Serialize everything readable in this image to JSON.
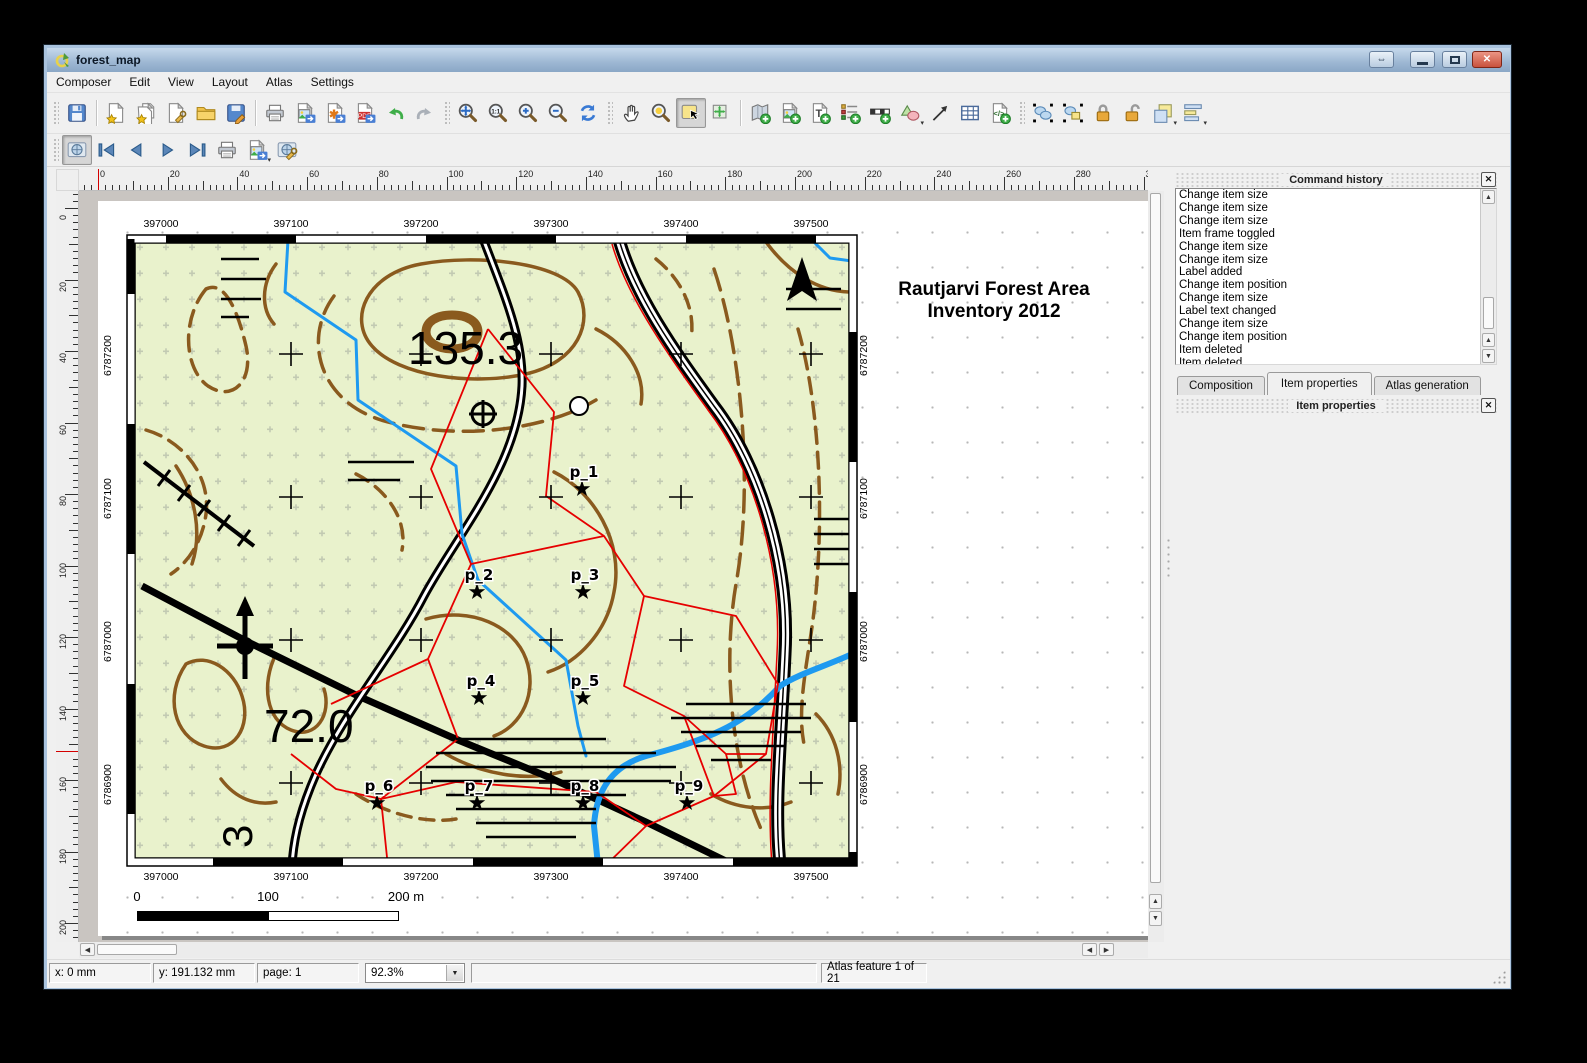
{
  "window": {
    "title": "forest_map"
  },
  "titlebar": {
    "buttons": [
      {
        "name": "resize",
        "glyph": "arrows"
      },
      {
        "name": "minimize",
        "glyph": "minimize"
      },
      {
        "name": "maximize",
        "glyph": "maximize"
      },
      {
        "name": "close",
        "glyph": "close"
      }
    ]
  },
  "menu": {
    "items": [
      "Composer",
      "Edit",
      "View",
      "Layout",
      "Atlas",
      "Settings"
    ]
  },
  "toolbars": {
    "main": {
      "groups": [
        {
          "lead": "grip",
          "items": [
            {
              "name": "save-project",
              "icon": "save"
            }
          ]
        },
        {
          "lead": "sep",
          "items": [
            {
              "name": "new-composition",
              "icon": "page-star"
            },
            {
              "name": "duplicate-composition",
              "icon": "pages-star"
            },
            {
              "name": "composition-manager",
              "icon": "page-wrench"
            },
            {
              "name": "load-from-template",
              "icon": "folder"
            },
            {
              "name": "save-as-template",
              "icon": "save-edit"
            }
          ]
        },
        {
          "lead": "sep",
          "items": [
            {
              "name": "print",
              "icon": "print"
            },
            {
              "name": "export-as-image",
              "icon": "export-image"
            },
            {
              "name": "export-as-svg",
              "icon": "export-svg"
            },
            {
              "name": "export-as-pdf",
              "icon": "export-pdf"
            },
            {
              "name": "undo",
              "icon": "undo"
            },
            {
              "name": "redo",
              "icon": "redo"
            }
          ]
        },
        {
          "lead": "grip",
          "items": [
            {
              "name": "zoom-full",
              "icon": "zoom-full"
            },
            {
              "name": "zoom-actual-size",
              "icon": "zoom-11"
            },
            {
              "name": "zoom-in",
              "icon": "zoom-in"
            },
            {
              "name": "zoom-out",
              "icon": "zoom-out"
            },
            {
              "name": "refresh-view",
              "icon": "refresh"
            }
          ]
        },
        {
          "lead": "grip",
          "items": [
            {
              "name": "pan",
              "icon": "pan"
            },
            {
              "name": "zoom-region",
              "icon": "zoom-tool"
            },
            {
              "name": "select-move-item",
              "icon": "select",
              "pressed": true
            },
            {
              "name": "move-item-content",
              "icon": "move-content"
            }
          ]
        },
        {
          "lead": "sep",
          "items": [
            {
              "name": "add-new-map",
              "icon": "add-map"
            },
            {
              "name": "add-image",
              "icon": "add-image"
            },
            {
              "name": "add-new-label",
              "icon": "add-label"
            },
            {
              "name": "add-new-legend",
              "icon": "add-legend"
            },
            {
              "name": "add-new-scalebar",
              "icon": "add-scalebar"
            },
            {
              "name": "add-basic-shape",
              "icon": "add-shape",
              "dd": true
            },
            {
              "name": "add-arrow",
              "icon": "add-arrow"
            },
            {
              "name": "add-attribute-table",
              "icon": "add-table"
            },
            {
              "name": "add-html-frame",
              "icon": "add-html"
            }
          ]
        },
        {
          "lead": "grip",
          "items": [
            {
              "name": "group-items",
              "icon": "group"
            },
            {
              "name": "ungroup-items",
              "icon": "ungroup"
            },
            {
              "name": "lock-selected-items",
              "icon": "lock"
            },
            {
              "name": "unlock-all-items",
              "icon": "unlock"
            },
            {
              "name": "raise-selected-items",
              "icon": "raise",
              "dd": true
            },
            {
              "name": "align-selected-items",
              "icon": "align",
              "dd": true
            }
          ]
        }
      ]
    },
    "atlas": {
      "groups": [
        {
          "lead": "grip",
          "items": [
            {
              "name": "preview-atlas",
              "icon": "atlas-preview",
              "pressed": true
            },
            {
              "name": "first-feature",
              "icon": "first"
            },
            {
              "name": "previous-feature",
              "icon": "prev"
            },
            {
              "name": "next-feature",
              "icon": "next"
            },
            {
              "name": "last-feature",
              "icon": "last"
            },
            {
              "name": "print-atlas",
              "icon": "print"
            },
            {
              "name": "export-atlas-as-image",
              "icon": "export-image",
              "dd": true
            },
            {
              "name": "atlas-settings",
              "icon": "atlas-settings"
            }
          ]
        }
      ]
    }
  },
  "ruler": {
    "top_units": [
      0,
      20,
      40,
      60,
      80,
      100,
      120,
      140,
      160,
      180,
      200,
      220,
      240,
      260,
      280,
      300
    ],
    "left_units": [
      0,
      20,
      40,
      60,
      80,
      100,
      120,
      140,
      160,
      180,
      200
    ]
  },
  "command_history": {
    "title": "Command history",
    "items": [
      "Change item size",
      "Change item size",
      "Change item size",
      "Item frame toggled",
      "Change item size",
      "Change item size",
      "Label added",
      "Change item position",
      "Change item size",
      "Label text changed",
      "Change item size",
      "Change item position",
      "Item deleted",
      "Item deleted"
    ]
  },
  "tabs": [
    {
      "label": "Composition",
      "active": false
    },
    {
      "label": "Item properties",
      "active": true
    },
    {
      "label": "Atlas generation",
      "active": false
    }
  ],
  "item_properties": {
    "title": "Item properties"
  },
  "statusbar": {
    "x": "x: 0 mm",
    "y": "y: 191.132 mm",
    "page": "page: 1",
    "zoom": "92.3%",
    "atlas": "Atlas feature 1 of 21"
  },
  "page": {
    "map_title_line1": "Rautjarvi Forest Area",
    "map_title_line2": "Inventory 2012",
    "grid_x_labels": [
      "397000",
      "397100",
      "397200",
      "397300",
      "397400",
      "397500"
    ],
    "grid_y_labels": [
      "6787200",
      "6787100",
      "6787000",
      "6786900"
    ],
    "elevation_labels": [
      {
        "text": "135.3",
        "x": 282,
        "y": 130,
        "size": 46,
        "rotate": 0
      },
      {
        "text": "72.0",
        "x": 138,
        "y": 508,
        "size": 46,
        "rotate": 0
      },
      {
        "text": "3",
        "x": 126,
        "y": 614,
        "size": 42,
        "rotate": -90
      }
    ],
    "sample_points": [
      {
        "label": "p_1",
        "x": 456,
        "y": 255
      },
      {
        "label": "p_2",
        "x": 351,
        "y": 358
      },
      {
        "label": "p_3",
        "x": 457,
        "y": 358
      },
      {
        "label": "p_4",
        "x": 353,
        "y": 464
      },
      {
        "label": "p_5",
        "x": 457,
        "y": 464
      },
      {
        "label": "p_6",
        "x": 251,
        "y": 569
      },
      {
        "label": "p_7",
        "x": 351,
        "y": 569
      },
      {
        "label": "p_8",
        "x": 457,
        "y": 569
      },
      {
        "label": "p_9",
        "x": 561,
        "y": 569
      }
    ],
    "scalebar": {
      "labels": [
        "0",
        "100",
        "200 m"
      ]
    },
    "colors": {
      "land": "#e9f2cc",
      "contour": "#8a5a1e",
      "stream": "#1e9af0",
      "boundary": "#e60000",
      "road": "#000000"
    }
  }
}
